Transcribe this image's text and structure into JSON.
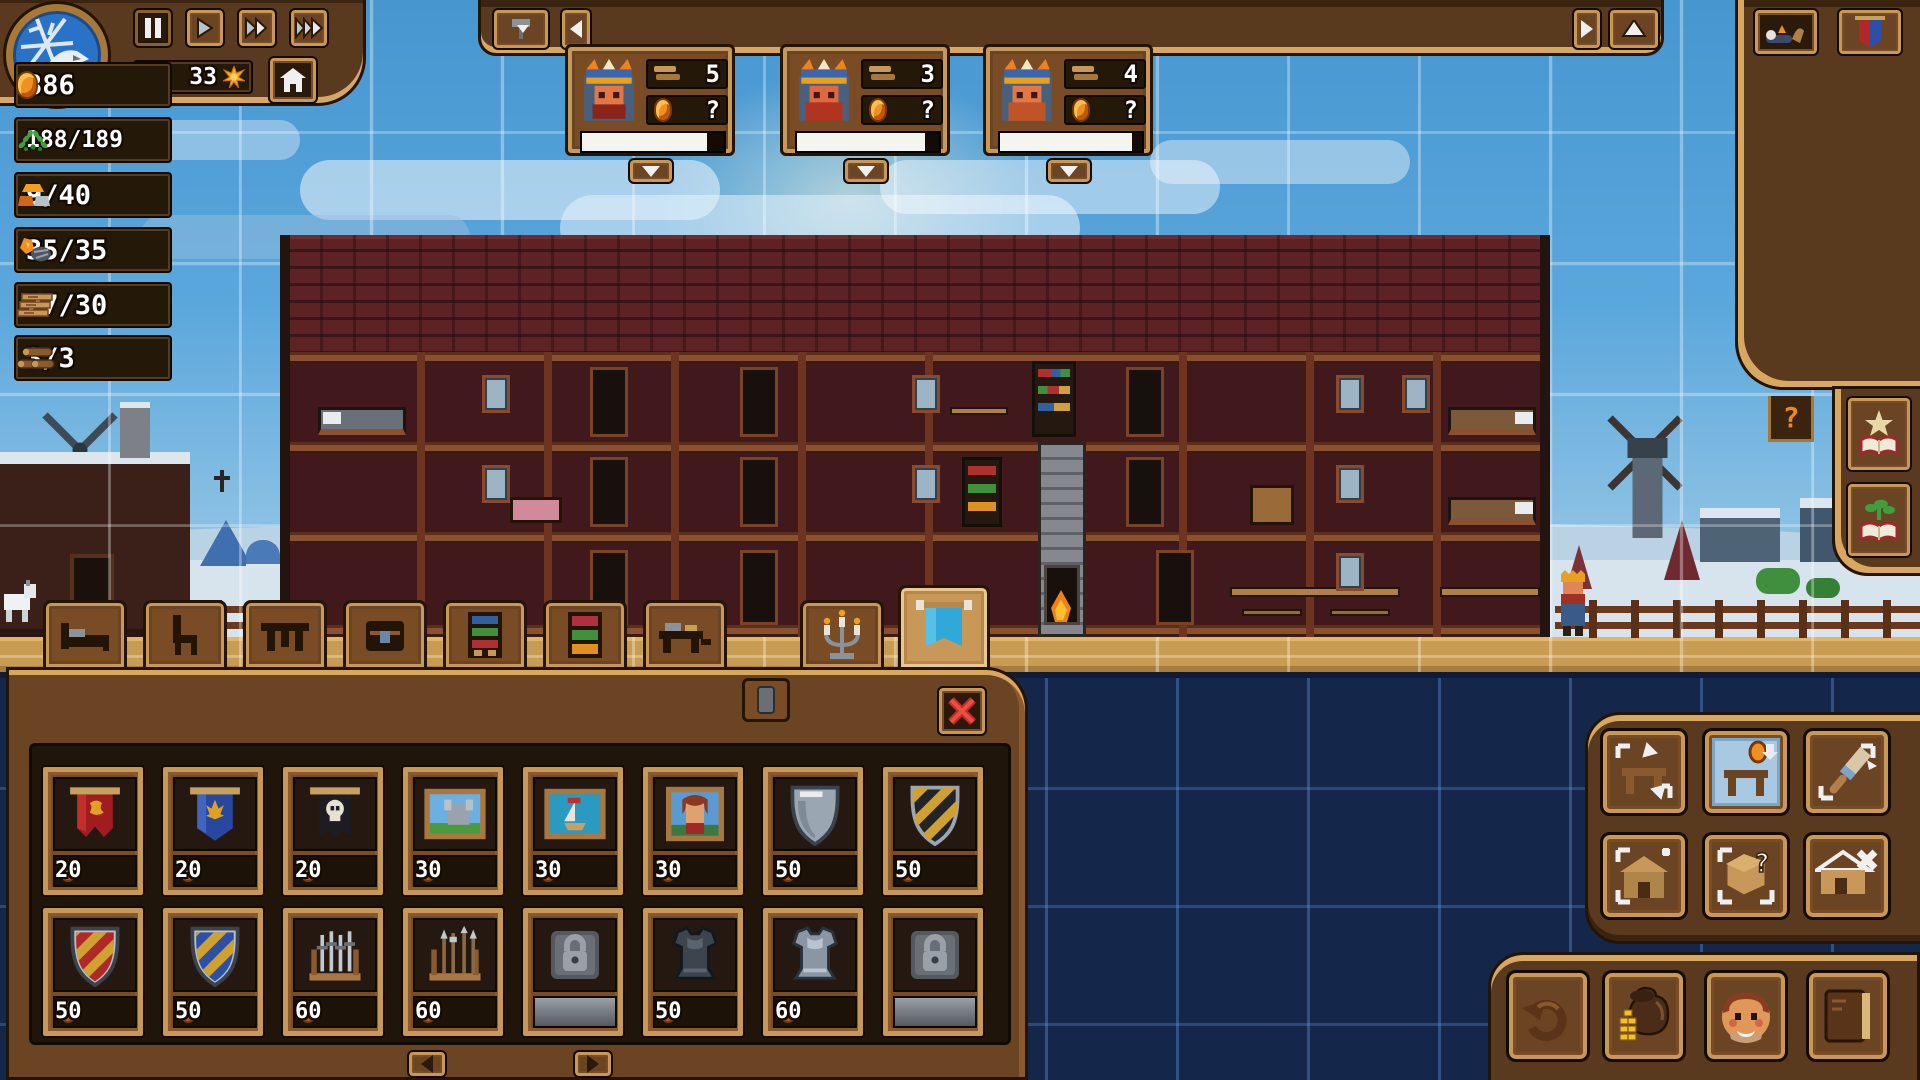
{
  "colors": {
    "wood": "#5a3a1e",
    "wood_light": "#c89858",
    "gold_trim": "#d9a860",
    "sky": "#4d9ed6",
    "underground": "#14274a",
    "coin": "#f09020",
    "selection_blue": "#a9c9e2",
    "locked_grey": "#8a8f96",
    "brick": "#5c2226"
  },
  "top_left": {
    "day": "33",
    "speed_controls": [
      "pause",
      "play",
      "fast-forward",
      "fastest"
    ],
    "home": "home-icon"
  },
  "top_bar": {
    "left_tools": [
      "hammer-tool-dropdown",
      "back-arrow"
    ],
    "right_tools": [
      "forward-arrow",
      "collapse-panel"
    ]
  },
  "kings": [
    {
      "beds": "5",
      "gold": "?",
      "progress": 88
    },
    {
      "beds": "3",
      "gold": "?",
      "progress": 90
    },
    {
      "beds": "4",
      "gold": "?",
      "progress": 93
    }
  ],
  "resources": {
    "rows": [
      {
        "name": "gold",
        "value": "886",
        "icon": "coin-icon"
      },
      {
        "name": "reputation",
        "value": "188/189",
        "icon": "laurel-icon"
      },
      {
        "name": "gold-bars",
        "value": "9/40",
        "icon": "ingots-icon"
      },
      {
        "name": "ore",
        "value": "35/35",
        "icon": "ore-icon"
      },
      {
        "name": "planks",
        "value": "27/30",
        "icon": "planks-icon"
      },
      {
        "name": "logs",
        "value": "3/3",
        "icon": "logs-icon"
      }
    ],
    "top_buttons": [
      "sleep-icon",
      "heraldry-icon"
    ],
    "side_buttons": [
      "quest-book-icon",
      "plant-book-icon"
    ]
  },
  "hint": {
    "label": "?"
  },
  "tabs": [
    "bed",
    "chair",
    "table",
    "chest",
    "bookshelf",
    "pantry",
    "desk",
    "candelabra",
    "banner"
  ],
  "shop": {
    "items": [
      {
        "name": "banner-red-lion",
        "price": "20"
      },
      {
        "name": "banner-blue-fleur",
        "price": "20"
      },
      {
        "name": "banner-black-skull",
        "price": "20"
      },
      {
        "name": "painting-castle",
        "price": "30"
      },
      {
        "name": "painting-ship",
        "price": "30"
      },
      {
        "name": "painting-portrait",
        "price": "30"
      },
      {
        "name": "shield-steel",
        "price": "50"
      },
      {
        "name": "shield-black-gold",
        "price": "50"
      },
      {
        "name": "shield-red-gold",
        "price": "50"
      },
      {
        "name": "shield-blue-gold",
        "price": "50"
      },
      {
        "name": "rack-swords",
        "price": "60"
      },
      {
        "name": "rack-spears",
        "price": "60"
      },
      {
        "name": "locked",
        "locked": true
      },
      {
        "name": "armor-dark",
        "price": "50"
      },
      {
        "name": "armor-steel",
        "price": "60"
      },
      {
        "name": "locked",
        "locked": true
      }
    ],
    "pager": [
      "page-left",
      "page-right"
    ]
  },
  "build_tools": [
    "move-furniture",
    "sell-furniture",
    "paint-furniture",
    "add-room",
    "query-box",
    "remove-room"
  ],
  "bottom_tools": [
    "undo",
    "finances",
    "character",
    "journal"
  ]
}
